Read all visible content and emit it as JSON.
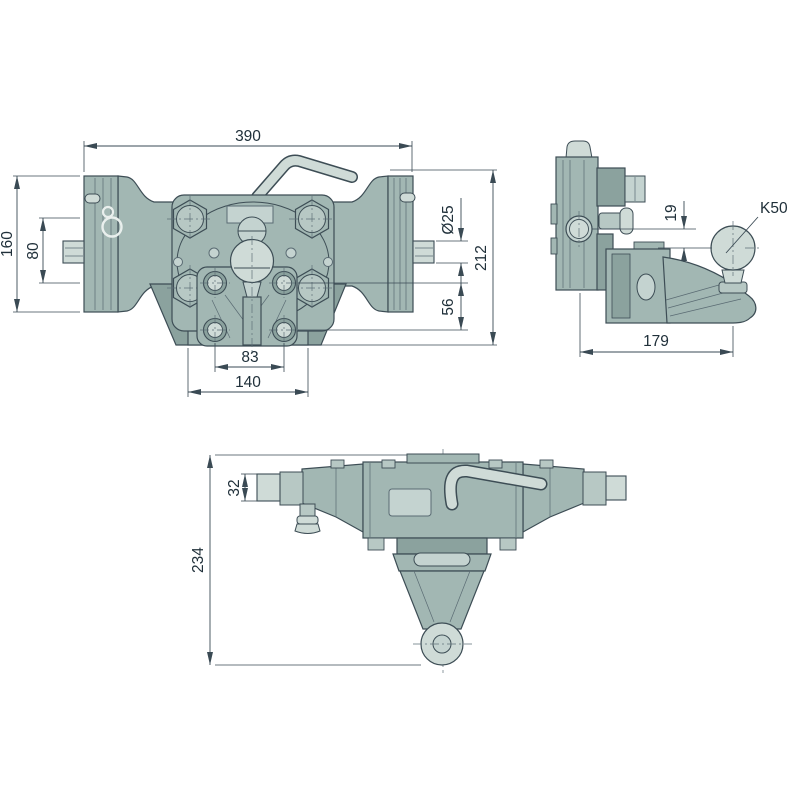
{
  "colors": {
    "body": "#a2b7b3",
    "mid": "#b7c8c4",
    "light": "#c4d3d0",
    "lighter": "#cfdbd7",
    "dark": "#8ba29e",
    "outline": "#3d4d55",
    "line": "#5a6b73",
    "center": "#5f7078",
    "dim": "#3a4a54",
    "text": "#20303a",
    "bg": "#ffffff"
  },
  "views": {
    "front": {
      "dims": {
        "overall_width": "390",
        "bracket_height": "160",
        "hole_spacing": "80",
        "pin_diameter": "Ø25",
        "total_height": "212",
        "flange_bolt_vertical": "56",
        "flange_bolt_horizontal": "83",
        "flange_width": "140"
      }
    },
    "side": {
      "dims": {
        "ball_offset": "19",
        "coupling_type": "K50",
        "overall_depth": "179"
      }
    },
    "top": {
      "dims": {
        "shaft_height": "32",
        "overall_depth": "234"
      }
    }
  }
}
